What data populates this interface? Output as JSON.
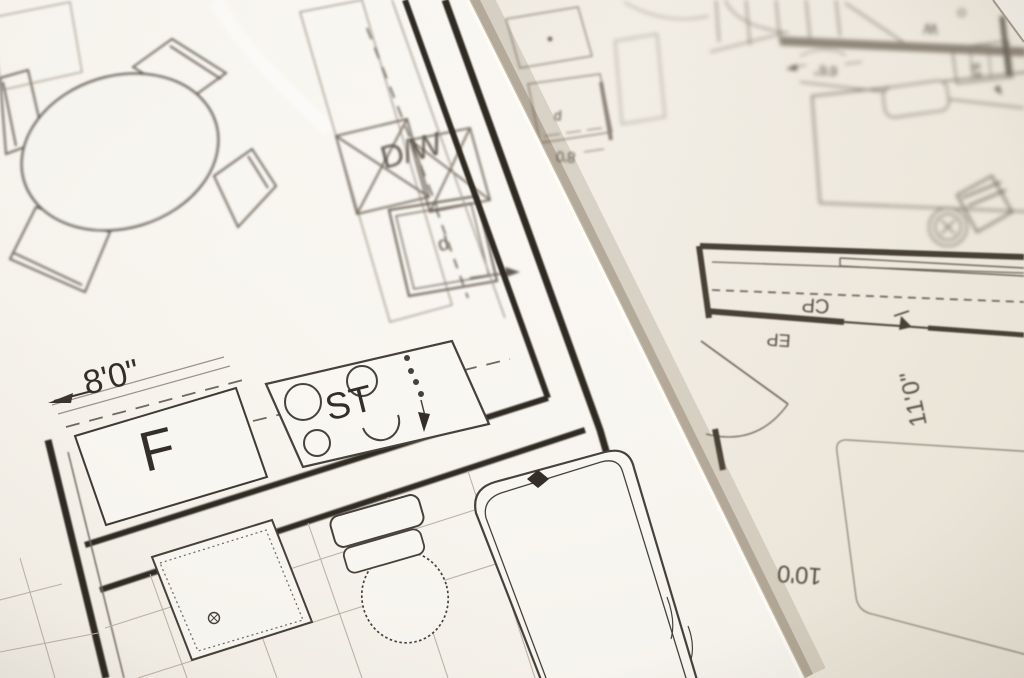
{
  "colors": {
    "paper_top": "#f8f5ef",
    "paper_under": "#f0eae0",
    "ink_sharp": "#332d27",
    "ink_soft": "#6e675d",
    "ink_under": "#7b7267",
    "edge_shadow": "rgba(105,88,66,0.30)"
  },
  "top_sheet": {
    "labels": {
      "dishwasher": "D/W",
      "refrigerator": "F",
      "stove": "ST",
      "cabinet": "d"
    },
    "dimensions": {
      "kitchen_counter": "8'0\""
    }
  },
  "under_sheet": {
    "labels": {
      "closet": "CP",
      "entry": "EP",
      "letter_w": "W",
      "letter_o": "O",
      "pantry": "p"
    },
    "dimensions": {
      "closet_width": "6'6\"",
      "bedroom_width": "11'0\"",
      "bedroom_length": "10'0",
      "bed_width": "4'8",
      "counter_width": "8'0"
    }
  }
}
